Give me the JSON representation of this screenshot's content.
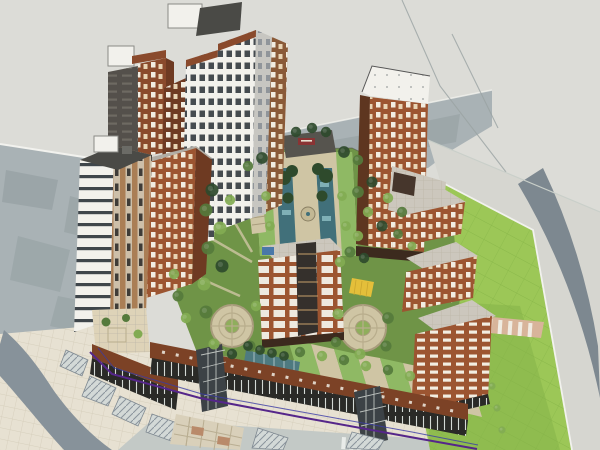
{
  "meta": {
    "width": 600,
    "height": 450,
    "view": "aerial-isometric",
    "render_style": "sketchup-architectural-model",
    "description": "3D massing model of a mixed-use residential complex: high-rise towers around a central landscaped water-axis courtyard, terracotta mid-rise blocks, a commercial podium along the south street, circular garden plazas, a large lawn park and surrounding roads"
  },
  "colors": {
    "background": "#dcdcd7",
    "context": "#a9b2b5",
    "context_dark": "#8d989c",
    "pavement": "#d6d6d0",
    "road_dark": "#7d8890",
    "road_sw": "#87929a",
    "sidewalk_cream": "#e7e1d2",
    "street": "#c3c9c6",
    "lawn": "#9cc757",
    "lawn_shade": "#85b248",
    "garden": "#6f9447",
    "path_tan": "#cfc5a4",
    "water": "#41707a",
    "glass_skylight": "#4e7a80",
    "terracotta": "#9c5531",
    "terracotta_dark": "#6e3a22",
    "brick_mid": "#8a4a2c",
    "facade_white": "#f2f1ec",
    "facade_gray": "#c7c6c1",
    "roof_dark": "#4a4a46",
    "roof_paved": "#ccc7bd",
    "storefront": "#2a2a27",
    "fascia": "#7c4226",
    "boundary_purple": "#55268a",
    "boundary_blue": "#3b3ba6",
    "tree_dark": "#2e4a2c",
    "tree_mid": "#557a3c",
    "tree_light": "#82ab52",
    "playground_yellow": "#e4bf3a",
    "crosswalk_pink": "#d8b49a",
    "sign_red": "#8a3434",
    "skylight_blue": "#4a78a8",
    "curb_white": "#f2f2ee"
  },
  "scene": {
    "regions": [
      "surrounding-roads",
      "ghosted-context-blocks",
      "central-water-garden",
      "circular-plazas",
      "residential-tower-cluster-west",
      "residential-tower-east",
      "mid-rise-terracotta-blocks",
      "commercial-podium-south",
      "lawn-park-east",
      "sidewalk-plaza-southwest"
    ],
    "buildings": [
      {
        "name": "west-white-tower",
        "type": "high-rise",
        "facade": "white-with-dark-window-bands",
        "roof": "dark-with-white-penthouse"
      },
      {
        "name": "northwest-back-towers",
        "type": "high-rise-pair",
        "facade": "dark-gray-and-brick",
        "roof": "white-penthouse-boxes"
      },
      {
        "name": "central-tall-cluster",
        "type": "high-rise-slabs",
        "facade": "white-window-grid-with-terracotta-trim",
        "roof": "dark-machine-room"
      },
      {
        "name": "west-mid-rise",
        "type": "mid-rise",
        "facade": "terracotta-with-white-windows",
        "roof": "paved-gray"
      },
      {
        "name": "east-tower",
        "type": "high-rise",
        "facade": "terracotta-random-white-windows",
        "roof": "white-slab-with-vents"
      },
      {
        "name": "east-slab-1",
        "type": "mid-rise",
        "facade": "terracotta",
        "roof": "paved-gray"
      },
      {
        "name": "east-slab-2",
        "type": "mid-rise",
        "facade": "terracotta",
        "roof": "paved-gray"
      },
      {
        "name": "east-slab-3",
        "type": "mid-rise",
        "facade": "terracotta-white-dashes",
        "roof": "paved-gray"
      },
      {
        "name": "central-mid-rise",
        "type": "mid-rise",
        "facade": "terracotta-white-panels-dark-core",
        "roof": "paved-gray-blue-skylight"
      },
      {
        "name": "south-commercial-podium",
        "type": "podium",
        "facade": "brown-fascia-dark-glass-storefronts",
        "feature": "glass-atriums"
      }
    ],
    "landscape": [
      {
        "name": "water-axis",
        "feature": "twin-reflecting-pools-with-fountain-and-tree-rows"
      },
      {
        "name": "axis-head-gate",
        "feature": "dark-pavilion-with-red-sign"
      },
      {
        "name": "circular-plaza-west",
        "feature": "ring-path-with-lawn-center"
      },
      {
        "name": "circular-plaza-east",
        "feature": "ring-path-with-lawn-center"
      },
      {
        "name": "south-garden-strips",
        "feature": "alternating-planting-beds-and-paths"
      },
      {
        "name": "glass-skylight-strip",
        "feature": "teal-glazing-over-basement"
      },
      {
        "name": "playground",
        "feature": "yellow-safety-surface"
      },
      {
        "name": "lawn-park",
        "feature": "gridded-lawn-with-pink-crosswalk-path"
      },
      {
        "name": "street-canopies",
        "feature": "hatched-glass-entry-canopies"
      },
      {
        "name": "checker-plaza",
        "feature": "checkerboard-paving"
      },
      {
        "name": "site-boundary",
        "feature": "purple-and-blue-property-lines"
      }
    ]
  }
}
